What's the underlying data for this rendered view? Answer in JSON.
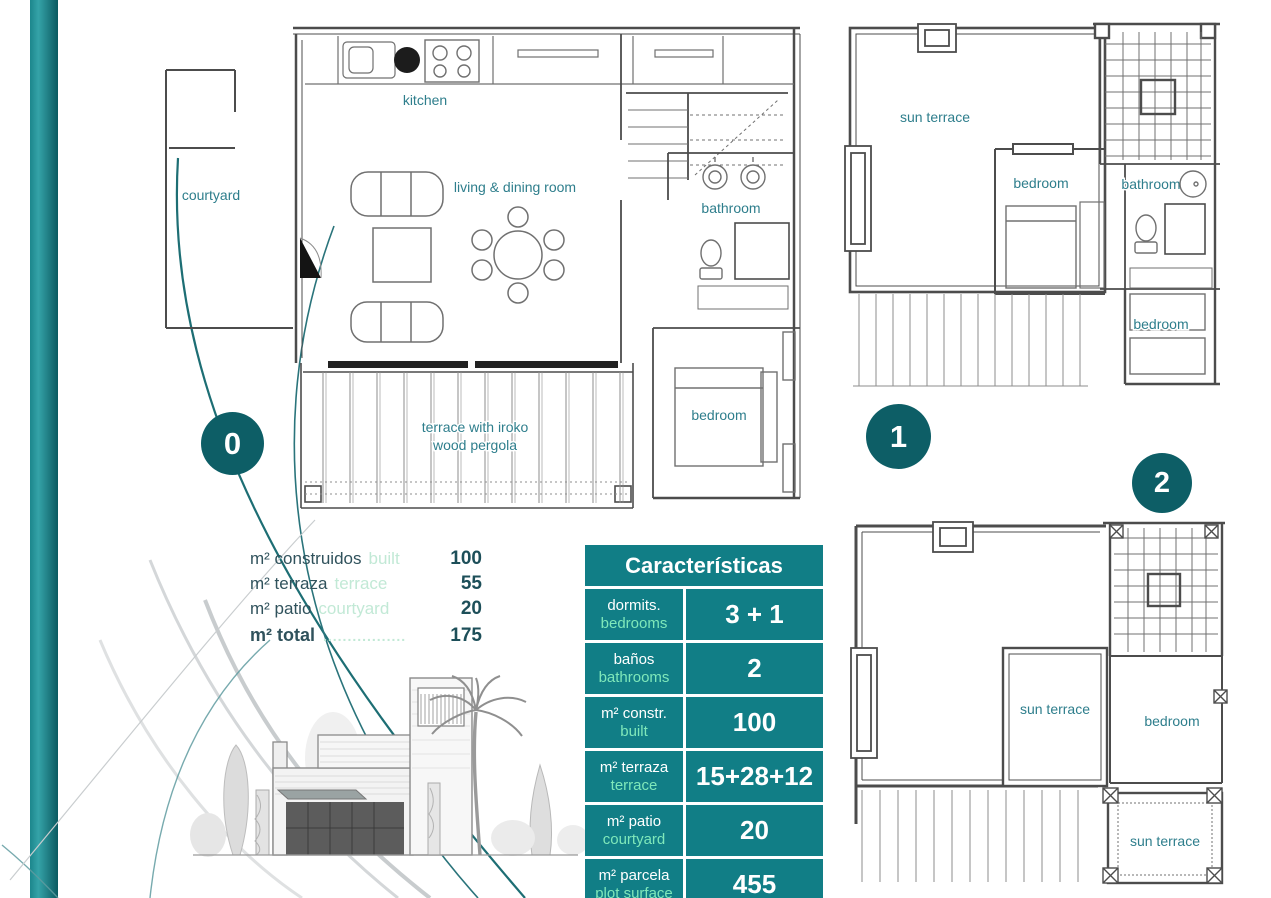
{
  "document": {
    "kind": "villa floor-plan brochure page"
  },
  "colors": {
    "teal_table": "#117e86",
    "teal_badge": "#0d5e66",
    "mint": "#7fe8ba",
    "mint_light": "#c2e9d6",
    "text_dark": "#30525c",
    "plan_label": "#2e7e8c"
  },
  "plan0": {
    "badge": "0",
    "kitchen": "kitchen",
    "courtyard": "courtyard",
    "living": "living & dining room",
    "bathroom": "bathroom",
    "bedroom": "bedroom",
    "terrace1": "terrace with iroko",
    "terrace2": "wood pergola"
  },
  "plan1": {
    "badge": "1",
    "sun_terrace": "sun terrace",
    "bedroom1": "bedroom",
    "bathroom": "bathroom",
    "bedroom2": "bedroom"
  },
  "plan2": {
    "badge": "2",
    "sun_terrace1": "sun terrace",
    "bedroom": "bedroom",
    "sun_terrace2": "sun terrace"
  },
  "measurements": {
    "rows": [
      {
        "label": "m² construidos",
        "en": "built",
        "value": "100"
      },
      {
        "label": "m² terraza",
        "en": "terrace",
        "value": "55"
      },
      {
        "label": "m² patio",
        "en": "courtyard",
        "value": "20"
      }
    ],
    "total": {
      "label": "m² total",
      "dots": ".................",
      "value": "175"
    }
  },
  "table": {
    "title": "Características",
    "rows": [
      {
        "es": "dormits.",
        "en": "bedrooms",
        "value": "3 + 1"
      },
      {
        "es": "baños",
        "en": "bathrooms",
        "value": "2"
      },
      {
        "es": "m² constr.",
        "en": "built",
        "value": "100"
      },
      {
        "es": "m² terraza",
        "en": "terrace",
        "value": "15+28+12"
      },
      {
        "es": "m² patio",
        "en": "courtyard",
        "value": "20"
      },
      {
        "es": "m² parcela",
        "en": "plot surface",
        "value": "455"
      }
    ]
  }
}
